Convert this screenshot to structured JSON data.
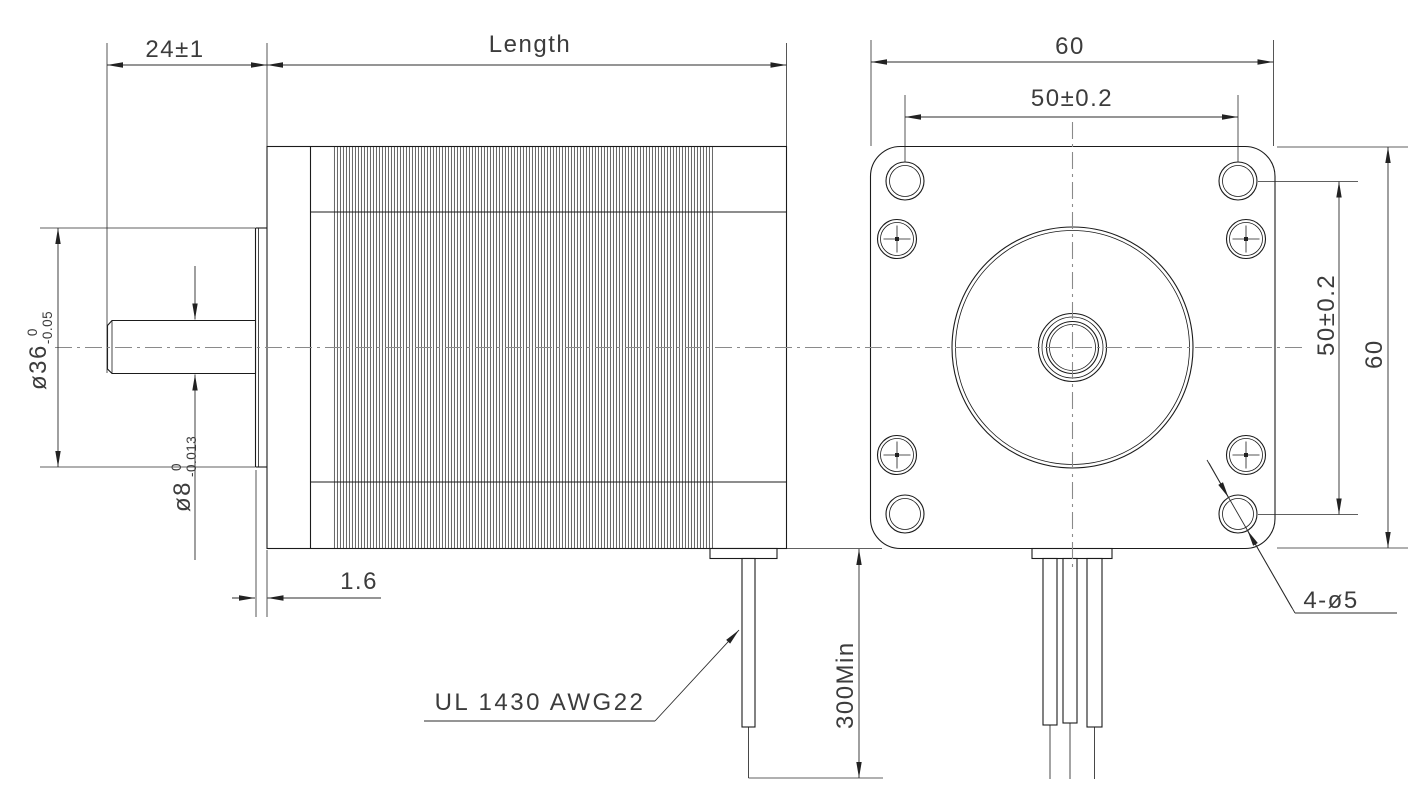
{
  "drawing": {
    "side_view": {
      "dim_shaft_extension": "24±1",
      "dim_body_length": "Length",
      "dim_boss_diameter": {
        "nominal": "ø36",
        "upper_tol": "0",
        "lower_tol": "-0.05"
      },
      "dim_shaft_diameter": {
        "nominal": "ø8",
        "upper_tol": "0",
        "lower_tol": "-0.013"
      },
      "dim_boss_depth": "1.6",
      "lead_wire_spec": "UL 1430 AWG22",
      "dim_lead_wire_length": "300Min"
    },
    "front_view": {
      "dim_width_top": "60",
      "dim_hole_spacing_top": "50±0.2",
      "dim_hole_spacing_right": "50±0.2",
      "dim_height_right": "60",
      "dim_mounting_holes": "4-ø5"
    },
    "colors": {
      "line": "#1b1b1b",
      "centerline": "#8a8a8a",
      "background": "#ffffff"
    }
  }
}
